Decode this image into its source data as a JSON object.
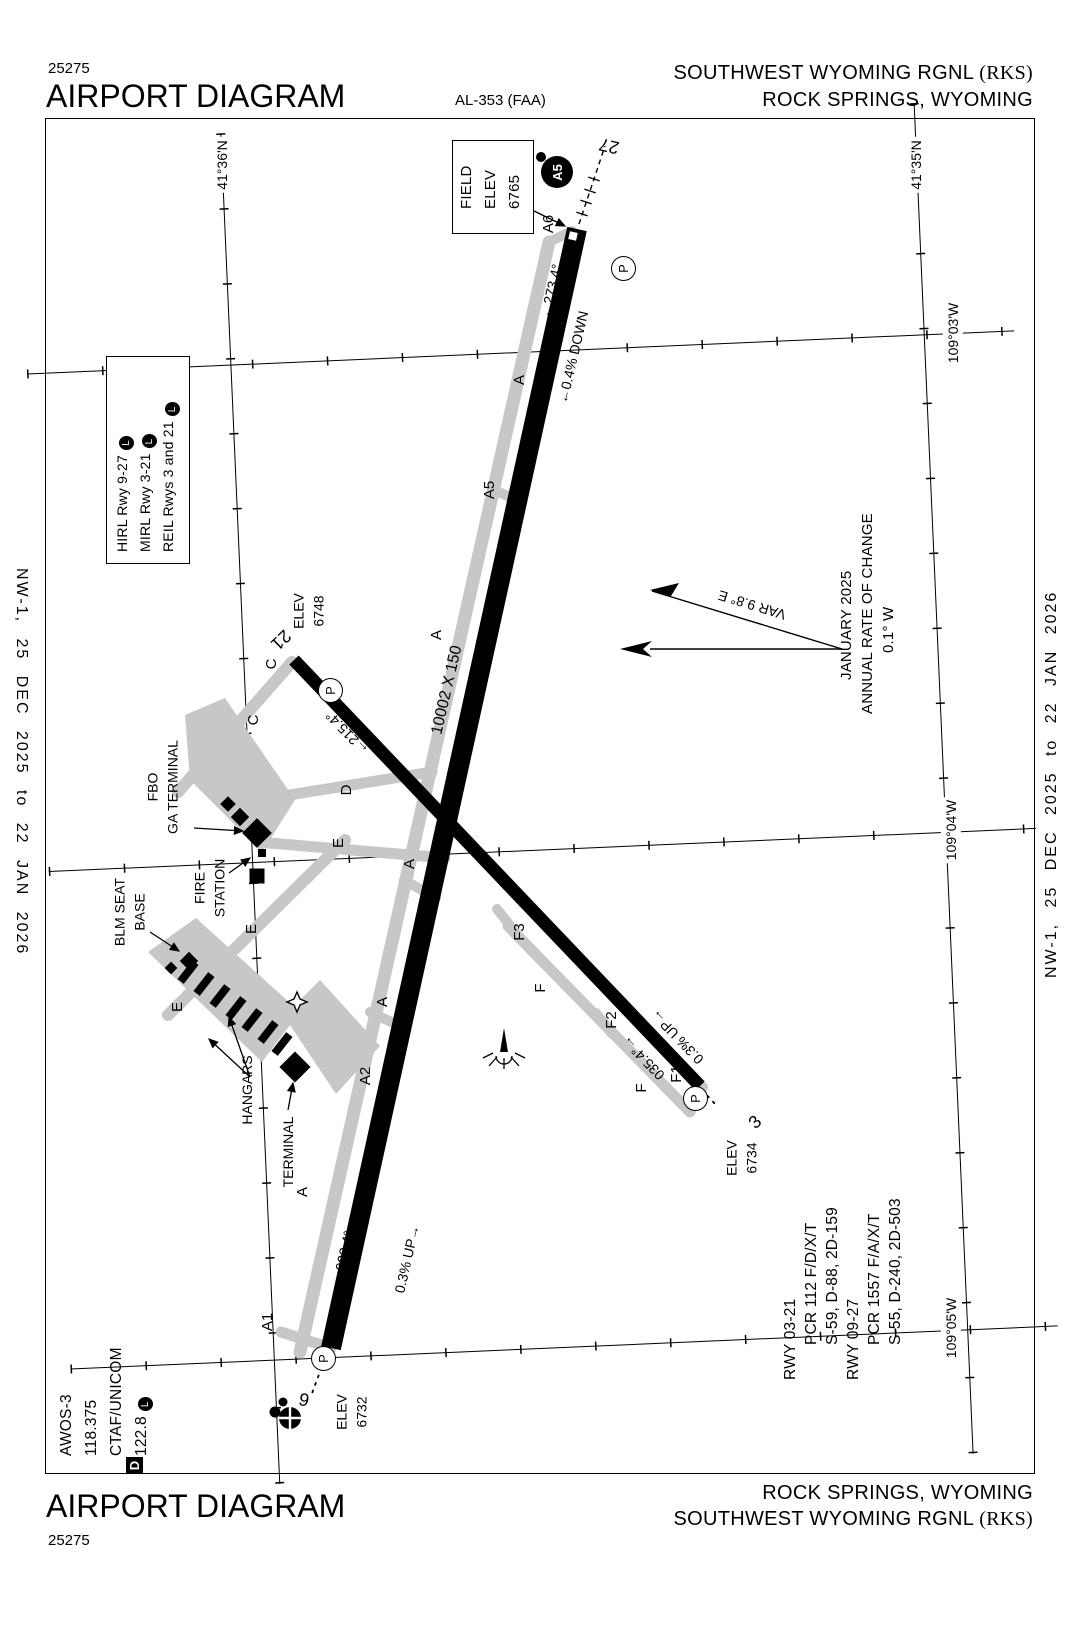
{
  "header": {
    "chart_number": "25275",
    "title": "AIRPORT DIAGRAM",
    "procedure_id": "AL-353 (FAA)",
    "airport_name": "SOUTHWEST WYOMING RGNL",
    "airport_id": "(RKS)",
    "city": "ROCK SPRINGS, WYOMING"
  },
  "footer": {
    "chart_number": "25275",
    "title": "AIRPORT DIAGRAM",
    "airport_name": "SOUTHWEST WYOMING RGNL",
    "airport_id": "(RKS)",
    "city": "ROCK SPRINGS, WYOMING"
  },
  "margin_note": "NW-1, 25 DEC 2025 to 22 JAN 2026",
  "field_elevation": {
    "l1": "FIELD",
    "l2": "ELEV",
    "l3": "6765"
  },
  "lighting_box": {
    "lines": [
      "HIRL Rwy 9-27",
      "MIRL Rwy 3-21",
      "REIL Rwys 3 and 21"
    ]
  },
  "comm": {
    "lines": [
      "AWOS-3",
      "118.375",
      "CTAF/UNICOM",
      "122.8"
    ]
  },
  "magvar": {
    "var_label": "VAR 9.8° E",
    "date": "JANUARY 2025",
    "note": "ANNUAL RATE OF CHANGE",
    "rate": "0.1° W"
  },
  "runway_data": {
    "lines": [
      {
        "text": "RWY 03-21"
      },
      {
        "text": "PCR 112 F/D/X/T"
      },
      {
        "text": "S-59, D-88, 2D-159"
      },
      {
        "text": "RWY 09-27"
      },
      {
        "text": "PCR 1557 F/A/X/T"
      },
      {
        "text": "S-55, D-240, 2D-503"
      }
    ]
  },
  "symbols": {
    "pcl": "L",
    "hold": "P",
    "sign_a5": "A5",
    "data_badge": "D"
  },
  "colors": {
    "ink": "#000000",
    "taxiway_gray": "#c7c7c7"
  },
  "map_labels": [
    {
      "n": "rwy27-heading",
      "t": "←273.4°",
      "x": 551,
      "y": 291,
      "r": -77,
      "s": 14
    },
    {
      "n": "rwy27-slope",
      "t": "←0.4% DOWN",
      "x": 573,
      "y": 357,
      "r": -77,
      "s": 14
    },
    {
      "n": "rwy927-dimensions",
      "t": "10002 X 150",
      "x": 447,
      "y": 690,
      "r": -77,
      "s": 16
    },
    {
      "n": "rwy9-heading",
      "t": "093.4°→",
      "x": 346,
      "y": 1244,
      "r": -77,
      "s": 14
    },
    {
      "n": "rwy9-slope",
      "t": "0.3% UP→",
      "x": 407,
      "y": 1259,
      "r": -77,
      "s": 14
    },
    {
      "n": "rwy21-heading",
      "t": "←215.4°",
      "x": 347,
      "y": 733,
      "r": -134,
      "s": 14
    },
    {
      "n": "rwy321-dimensions",
      "t": "5228 X 75",
      "x": 529,
      "y": 906,
      "r": -134,
      "s": 16
    },
    {
      "n": "rwy3-heading",
      "t": "035.4°→",
      "x": 643,
      "y": 1058,
      "r": -134,
      "s": 14
    },
    {
      "n": "rwy3-slope",
      "t": "0.3% UP→",
      "x": 677,
      "y": 1037,
      "r": -134,
      "s": 14
    },
    {
      "n": "rwy9-number",
      "t": "9",
      "x": 304,
      "y": 1400,
      "r": 13,
      "s": 18
    },
    {
      "n": "rwy27-number",
      "t": "27",
      "x": 609,
      "y": 146,
      "r": 193,
      "s": 18
    },
    {
      "n": "rwy3-number",
      "t": "3",
      "x": 755,
      "y": 1122,
      "r": -44,
      "s": 18
    },
    {
      "n": "rwy21-number",
      "t": "21",
      "x": 281,
      "y": 640,
      "r": 136,
      "s": 18
    },
    {
      "n": "rwy9-elevation",
      "t": "ELEV\n6732",
      "x": 352,
      "y": 1412,
      "r": -90,
      "s": 14
    },
    {
      "n": "rwy21-elevation",
      "t": "ELEV\n6748",
      "x": 309,
      "y": 611,
      "r": -90,
      "s": 14
    },
    {
      "n": "rwy3-elevation",
      "t": "ELEV\n6734",
      "x": 742,
      "y": 1158,
      "r": -90,
      "s": 14
    },
    {
      "n": "taxiway-a-label",
      "t": "A",
      "x": 520,
      "y": 380,
      "r": -90,
      "s": 15
    },
    {
      "n": "taxiway-a5-label",
      "t": "A5",
      "x": 490,
      "y": 490,
      "r": -90,
      "s": 15
    },
    {
      "n": "taxiway-a-label",
      "t": "A",
      "x": 437,
      "y": 635,
      "r": -90,
      "s": 15
    },
    {
      "n": "taxiway-a-label",
      "t": "A",
      "x": 410,
      "y": 864,
      "r": -90,
      "s": 15
    },
    {
      "n": "taxiway-a3-label",
      "t": "A3",
      "x": 421,
      "y": 925,
      "r": -90,
      "s": 15
    },
    {
      "n": "taxiway-a-label",
      "t": "A",
      "x": 383,
      "y": 1002,
      "r": -90,
      "s": 15
    },
    {
      "n": "taxiway-a2-label",
      "t": "A2",
      "x": 366,
      "y": 1076,
      "r": -90,
      "s": 15
    },
    {
      "n": "taxiway-a-label",
      "t": "A",
      "x": 303,
      "y": 1192,
      "r": -90,
      "s": 15
    },
    {
      "n": "taxiway-a1-label",
      "t": "A1",
      "x": 268,
      "y": 1322,
      "r": -90,
      "s": 15
    },
    {
      "n": "taxiway-a6-label",
      "t": "A6",
      "x": 549,
      "y": 224,
      "r": -90,
      "s": 15
    },
    {
      "n": "taxiway-c-label",
      "t": "C",
      "x": 272,
      "y": 664,
      "r": -90,
      "s": 15
    },
    {
      "n": "taxiway-c-label",
      "t": "C",
      "x": 254,
      "y": 720,
      "r": -90,
      "s": 15
    },
    {
      "n": "taxiway-d-label",
      "t": "D",
      "x": 347,
      "y": 790,
      "r": -90,
      "s": 15
    },
    {
      "n": "taxiway-e-label",
      "t": "E",
      "x": 339,
      "y": 843,
      "r": -90,
      "s": 15
    },
    {
      "n": "taxiway-e-label",
      "t": "E",
      "x": 252,
      "y": 929,
      "r": -90,
      "s": 15
    },
    {
      "n": "taxiway-e-label",
      "t": "E",
      "x": 178,
      "y": 1007,
      "r": -90,
      "s": 15
    },
    {
      "n": "taxiway-f3-label",
      "t": "F3",
      "x": 520,
      "y": 932,
      "r": -90,
      "s": 15
    },
    {
      "n": "taxiway-f-label",
      "t": "F",
      "x": 541,
      "y": 988,
      "r": -90,
      "s": 15
    },
    {
      "n": "taxiway-f2-label",
      "t": "F2",
      "x": 612,
      "y": 1020,
      "r": -90,
      "s": 15
    },
    {
      "n": "taxiway-f-label",
      "t": "F",
      "x": 642,
      "y": 1088,
      "r": -90,
      "s": 15
    },
    {
      "n": "taxiway-f1-label",
      "t": "F1",
      "x": 677,
      "y": 1074,
      "r": -90,
      "s": 15
    },
    {
      "n": "fbo-ga-terminal-label",
      "t": "FBO\nGA TERMINAL",
      "x": 163,
      "y": 787,
      "r": -90,
      "s": 14
    },
    {
      "n": "fire-station-label",
      "t": "FIRE\nSTATION",
      "x": 210,
      "y": 888,
      "r": -90,
      "s": 14
    },
    {
      "n": "blm-seat-base-label",
      "t": "BLM SEAT\nBASE",
      "x": 130,
      "y": 912,
      "r": -90,
      "s": 14
    },
    {
      "n": "hangars-label",
      "t": "HANGARS",
      "x": 247,
      "y": 1090,
      "r": -90,
      "s": 14
    },
    {
      "n": "terminal-label",
      "t": "TERMINAL",
      "x": 288,
      "y": 1152,
      "r": -90,
      "s": 14
    },
    {
      "n": "lat-label-41-36N",
      "t": "41°36'N",
      "x": 222,
      "y": 165,
      "r": -90,
      "s": 14,
      "bg": true
    },
    {
      "n": "lat-label-41-35N",
      "t": "41°35'N",
      "x": 916,
      "y": 165,
      "r": -90,
      "s": 14,
      "bg": true
    },
    {
      "n": "lon-label-109-03W",
      "t": "109°03'W",
      "x": 953,
      "y": 333,
      "r": -90,
      "s": 14,
      "bg": true
    },
    {
      "n": "lon-label-109-04W",
      "t": "109°04'W",
      "x": 951,
      "y": 830,
      "r": -90,
      "s": 14,
      "bg": true
    },
    {
      "n": "lon-label-109-05W",
      "t": "109°05'W",
      "x": 951,
      "y": 1328,
      "r": -90,
      "s": 14,
      "bg": true
    },
    {
      "n": "magnetic-variation-label",
      "t": "VAR 9.8° E",
      "x": 752,
      "y": 605,
      "r": -163,
      "s": 14
    }
  ]
}
